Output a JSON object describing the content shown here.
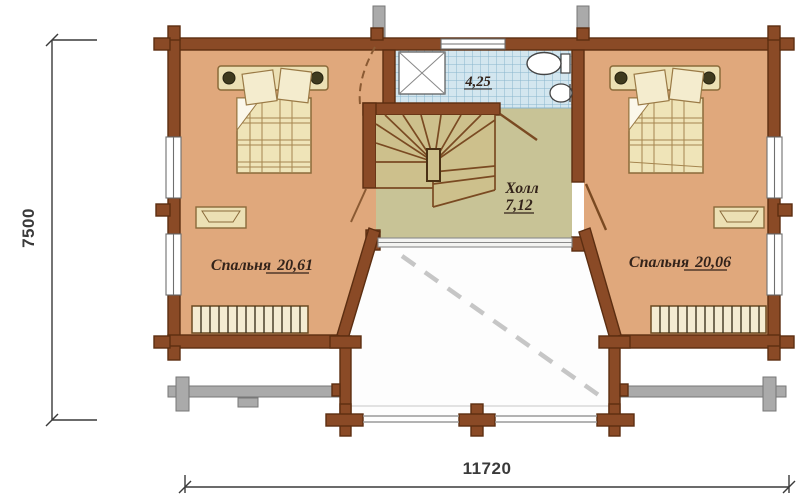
{
  "plan": {
    "dim_height": "7500",
    "dim_width": "11720",
    "rooms": {
      "bedroom_left": {
        "name": "Спальня",
        "area": "20,61"
      },
      "bedroom_right": {
        "name": "Спальня",
        "area": "20,06"
      },
      "hall": {
        "name": "Холл",
        "area": "7,12"
      },
      "bathroom": {
        "area": "4,25"
      }
    },
    "symbols": [
      "bed",
      "pillow",
      "blanket",
      "shower",
      "toilet",
      "sink",
      "radiator",
      "winder-stairs",
      "door-swing",
      "window",
      "balcony-railing",
      "log-wall",
      "roof-beam"
    ],
    "colors": {
      "wall": "#8a4a26",
      "wall-dark": "#5c2e11",
      "wall-line": "#7a4a22",
      "floor-bedroom": "#e0a87c",
      "floor-hall": "#c8c396",
      "floor-stairs": "#cdc08c",
      "tile": "#d3e6ef",
      "tile-line": "#8ab5cd",
      "furniture": "#ece0b4",
      "furniture-line": "#8a6a3a",
      "blanket": "#efe4b8",
      "plaid-line": "#a5854f",
      "gray": "#aaaaaa",
      "gray-dark": "#777777",
      "dash": "#c6c6c6",
      "dim": "#3a3a3a",
      "label": "#33231a",
      "white": "#ffffff"
    }
  }
}
